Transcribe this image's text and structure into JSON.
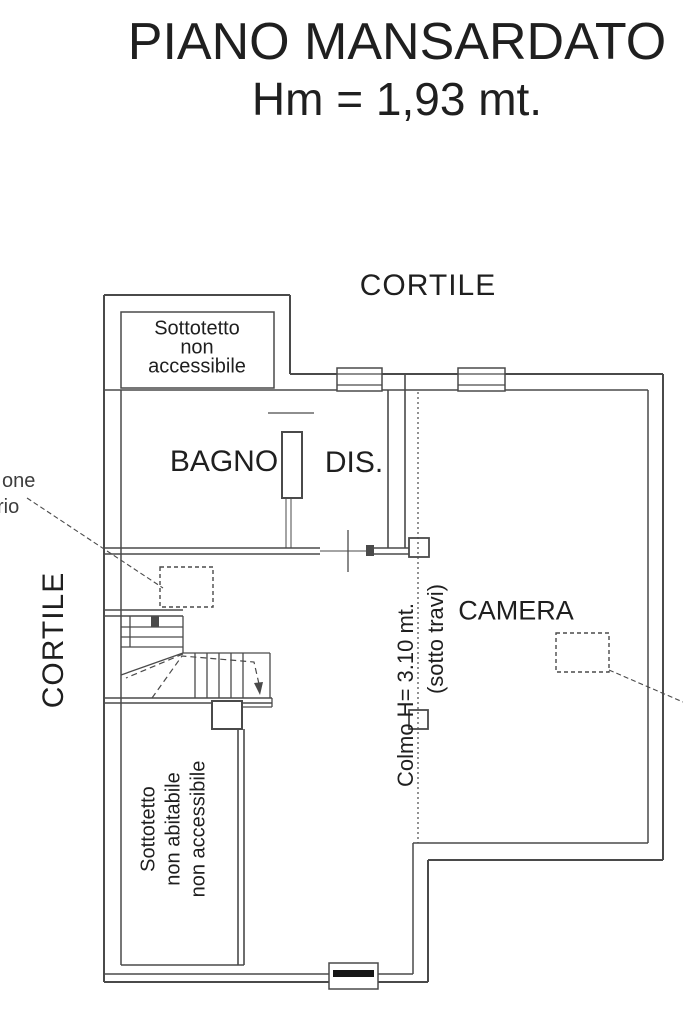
{
  "page": {
    "background": "#ffffff",
    "line_color": "#4a4a4a",
    "text_color": "#1f1f1f"
  },
  "title": {
    "line1": "PIANO MANSARDATO",
    "line2": "Hm = 1,93 mt."
  },
  "areas": {
    "cortile_top": "CORTILE",
    "cortile_left": "CORTILE",
    "bagno": "BAGNO",
    "dis": "DIS.",
    "camera": "CAMERA"
  },
  "annotations": {
    "attic_top": [
      "Sottotetto",
      "non",
      "accessibile"
    ],
    "attic_bottom": [
      "Sottotetto",
      "non abitabile",
      "non accessibile"
    ],
    "ridge": "Colmo H= 3.10 mt.",
    "ridge_sub": "(sotto travi)",
    "cut_label_line1": "one",
    "cut_label_line2": "rio"
  }
}
